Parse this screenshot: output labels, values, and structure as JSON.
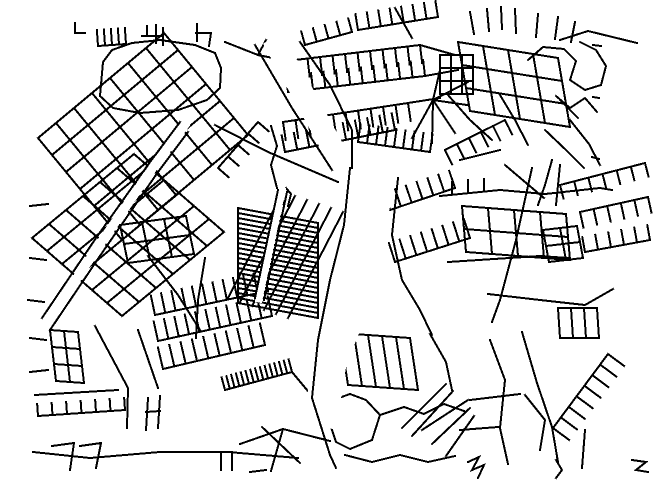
{
  "map": {
    "kind": "street-network-line-map",
    "canvas": {
      "width": 655,
      "height": 484
    },
    "colors": {
      "background": "#ffffff",
      "road": "#000000"
    },
    "stroke_width": 2,
    "grids": [
      {
        "o": [
          38,
          138
        ],
        "u": [
          14,
          17
        ],
        "nu": 6,
        "v": [
          18,
          -15
        ],
        "nv": 7
      },
      {
        "o": [
          32,
          238
        ],
        "u": [
          15,
          13
        ],
        "nu": 6,
        "v": [
          17,
          -14
        ],
        "nv": 6
      },
      {
        "o": [
          120,
          225
        ],
        "u": [
          22,
          -3
        ],
        "nu": 3,
        "v": [
          4,
          19
        ],
        "nv": 2
      },
      {
        "o": [
          238,
          208
        ],
        "u": [
          0,
          5
        ],
        "nu": 19,
        "v": [
          80,
          15
        ],
        "nv": 1
      },
      {
        "o": [
          458,
          42
        ],
        "u": [
          25,
          4
        ],
        "nu": 4,
        "v": [
          4,
          23
        ],
        "nv": 3
      },
      {
        "o": [
          462,
          206
        ],
        "u": [
          26,
          2
        ],
        "nu": 4,
        "v": [
          2,
          23
        ],
        "nv": 2
      },
      {
        "o": [
          543,
          230
        ],
        "u": [
          17,
          -2
        ],
        "nu": 2,
        "v": [
          3,
          16
        ],
        "nv": 2
      },
      {
        "o": [
          50,
          330
        ],
        "u": [
          14,
          1
        ],
        "nu": 2,
        "v": [
          2,
          17
        ],
        "nv": 3
      },
      {
        "o": [
          440,
          55
        ],
        "u": [
          11,
          0
        ],
        "nu": 3,
        "v": [
          0,
          13
        ],
        "nv": 3
      },
      {
        "o": [
          348,
          385
        ],
        "u": [
          14,
          1
        ],
        "nu": 5,
        "v": [
          -8,
          -52
        ],
        "nv": 1
      },
      {
        "o": [
          558,
          308
        ],
        "u": [
          13,
          0
        ],
        "nu": 3,
        "v": [
          2,
          30
        ],
        "nv": 1
      }
    ],
    "ladders": [
      {
        "a": [
          358,
          30
        ],
        "b": [
          438,
          17
        ],
        "n": 8,
        "len": 16,
        "ang": -90
      },
      {
        "a": [
          305,
          45
        ],
        "b": [
          352,
          32
        ],
        "n": 5,
        "len": 14,
        "ang": -90
      },
      {
        "a": [
          295,
          60
        ],
        "b": [
          420,
          45
        ],
        "n": 11,
        "len": 18,
        "ang": 90
      },
      {
        "a": [
          288,
          92
        ],
        "b": [
          425,
          76
        ],
        "n": 12,
        "len": 16,
        "ang": -90
      },
      {
        "a": [
          283,
          122
        ],
        "b": [
          408,
          103
        ],
        "n": 11,
        "len": 18,
        "ang": 90
      },
      {
        "a": [
          285,
          152
        ],
        "b": [
          395,
          130
        ],
        "n": 10,
        "len": 17,
        "ang": -90
      },
      {
        "a": [
          358,
          142
        ],
        "b": [
          430,
          152
        ],
        "n": 9,
        "len": 18,
        "ang": -90
      },
      {
        "a": [
          580,
          212
        ],
        "b": [
          648,
          197
        ],
        "n": 6,
        "len": 16,
        "ang": 90
      },
      {
        "a": [
          585,
          252
        ],
        "b": [
          650,
          240
        ],
        "n": 6,
        "len": 15,
        "ang": -90
      },
      {
        "a": [
          155,
          315
        ],
        "b": [
          268,
          291
        ],
        "n": 12,
        "len": 20,
        "ang": -90
      },
      {
        "a": [
          158,
          341
        ],
        "b": [
          272,
          316
        ],
        "n": 12,
        "len": 20,
        "ang": -90
      },
      {
        "a": [
          163,
          369
        ],
        "b": [
          265,
          345
        ],
        "n": 10,
        "len": 22,
        "ang": -90
      },
      {
        "a": [
          225,
          390
        ],
        "b": [
          292,
          372
        ],
        "n": 15,
        "len": 13,
        "ang": -90
      },
      {
        "a": [
          38,
          416
        ],
        "b": [
          125,
          410
        ],
        "n": 7,
        "len": 12,
        "ang": -90
      },
      {
        "a": [
          553,
          428
        ],
        "b": [
          608,
          354
        ],
        "n": 8,
        "len": 20,
        "ang": 90
      },
      {
        "a": [
          560,
          185
        ],
        "b": [
          645,
          163
        ],
        "n": 7,
        "len": 14,
        "ang": 90
      },
      {
        "a": [
          98,
          46
        ],
        "b": [
          126,
          44
        ],
        "n": 5,
        "len": 16,
        "ang": -90
      },
      {
        "a": [
          218,
          168
        ],
        "b": [
          258,
          122
        ],
        "n": 5,
        "len": 14,
        "ang": 90
      },
      {
        "a": [
          395,
          262
        ],
        "b": [
          470,
          238
        ],
        "n": 8,
        "len": 20,
        "ang": -90
      },
      {
        "a": [
          390,
          210
        ],
        "b": [
          455,
          188
        ],
        "n": 7,
        "len": 18,
        "ang": -90
      },
      {
        "a": [
          445,
          150
        ],
        "b": [
          505,
          120
        ],
        "n": 6,
        "len": 16,
        "ang": 90
      }
    ],
    "lines": [
      [
        75,
        23,
        75,
        33,
        85,
        33
      ],
      [
        142,
        36,
        163,
        36
      ],
      [
        147,
        26,
        147,
        36
      ],
      [
        156,
        25,
        156,
        43
      ],
      [
        163,
        28,
        163,
        45
      ],
      [
        197,
        24,
        197,
        41
      ],
      [
        196,
        33,
        211,
        33,
        209,
        46
      ],
      [
        100,
        96,
        103,
        62,
        112,
        50,
        132,
        43,
        160,
        40,
        195,
        45,
        215,
        53,
        221,
        68,
        220,
        88,
        207,
        100,
        178,
        110,
        140,
        113,
        113,
        108,
        100,
        96
      ],
      [
        215,
        125,
        268,
        152,
        310,
        170,
        338,
        182
      ],
      [
        225,
        42,
        258,
        55,
        283,
        60
      ],
      [
        258,
        55,
        266,
        40
      ],
      [
        277,
        188,
        271,
        165,
        277,
        146,
        271,
        126
      ],
      [
        284,
        206,
        281,
        193,
        286,
        188,
        291,
        194,
        288,
        206
      ],
      [
        240,
        302,
        295,
        196
      ],
      [
        252,
        306,
        307,
        200
      ],
      [
        264,
        310,
        319,
        204
      ],
      [
        276,
        314,
        331,
        208
      ],
      [
        288,
        318,
        343,
        212
      ],
      [
        228,
        298,
        283,
        192
      ],
      [
        433,
        100,
        468,
        82
      ],
      [
        433,
        100,
        467,
        105
      ],
      [
        433,
        100,
        455,
        133
      ],
      [
        433,
        100,
        432,
        143
      ],
      [
        433,
        100,
        412,
        138
      ],
      [
        433,
        100,
        440,
        70
      ],
      [
        560,
        40,
        588,
        31,
        637,
        43
      ],
      [
        470,
        12,
        474,
        34
      ],
      [
        487,
        9,
        489,
        31
      ],
      [
        501,
        7,
        502,
        29
      ],
      [
        515,
        9,
        516,
        33
      ],
      [
        538,
        14,
        536,
        37
      ],
      [
        558,
        17,
        555,
        39
      ],
      [
        575,
        22,
        571,
        42
      ],
      [
        395,
        8,
        412,
        38
      ],
      [
        528,
        60,
        543,
        47,
        564,
        49,
        576,
        61,
        570,
        80,
        585,
        90,
        601,
        85,
        606,
        66,
        596,
        50,
        580,
        42
      ],
      [
        593,
        45,
        601,
        46
      ],
      [
        593,
        97,
        599,
        98
      ],
      [
        592,
        157,
        599,
        159
      ],
      [
        570,
        120,
        589,
        144,
        600,
        165
      ],
      [
        560,
        100,
        578,
        118
      ],
      [
        545,
        130,
        566,
        150,
        584,
        168
      ],
      [
        556,
        96,
        570,
        108,
        585,
        98,
        597,
        112
      ],
      [
        440,
        196,
        500,
        190,
        545,
        194,
        600,
        188,
        612,
        190
      ],
      [
        452,
        182,
        452,
        194
      ],
      [
        468,
        180,
        468,
        192
      ],
      [
        484,
        179,
        484,
        191
      ],
      [
        448,
        262,
        540,
        256,
        568,
        258
      ],
      [
        532,
        168,
        516,
        240,
        500,
        300,
        492,
        322
      ],
      [
        488,
        294,
        540,
        300,
        585,
        305,
        613,
        289
      ],
      [
        505,
        165,
        525,
        182,
        544,
        198
      ],
      [
        552,
        160,
        545,
        185,
        538,
        205
      ],
      [
        560,
        165,
        556,
        205
      ],
      [
        448,
        95,
        470,
        120,
        492,
        140
      ],
      [
        500,
        95,
        515,
        120,
        528,
        145
      ],
      [
        460,
        160,
        500,
        150
      ],
      [
        420,
        45,
        455,
        55
      ],
      [
        425,
        76,
        458,
        70
      ],
      [
        408,
        103,
        440,
        98
      ],
      [
        35,
        395,
        118,
        390
      ],
      [
        33,
        452,
        90,
        458,
        160,
        452,
        228,
        452,
        298,
        458
      ],
      [
        52,
        446,
        74,
        443,
        70,
        470
      ],
      [
        80,
        446,
        101,
        443,
        96,
        468
      ],
      [
        148,
        398,
        146,
        430
      ],
      [
        160,
        396,
        158,
        428
      ],
      [
        146,
        412,
        160,
        411
      ],
      [
        95,
        326,
        128,
        388,
        127,
        428
      ],
      [
        138,
        330,
        158,
        388
      ],
      [
        30,
        372,
        48,
        370
      ],
      [
        30,
        338,
        46,
        340
      ],
      [
        221,
        470,
        221,
        452,
        232,
        452,
        232,
        470
      ],
      [
        250,
        472,
        266,
        470
      ],
      [
        240,
        444,
        283,
        429,
        330,
        441
      ],
      [
        262,
        427,
        300,
        463
      ],
      [
        283,
        429,
        271,
        471
      ],
      [
        333,
        400,
        350,
        394,
        366,
        400,
        380,
        415,
        372,
        440,
        350,
        449,
        336,
        442,
        330,
        424,
        333,
        400
      ],
      [
        380,
        415,
        404,
        407,
        424,
        414,
        444,
        404,
        464,
        411
      ],
      [
        345,
        455,
        372,
        462,
        400,
        455,
        428,
        462,
        455,
        456
      ],
      [
        468,
        400,
        422,
        430
      ],
      [
        470,
        408,
        432,
        444
      ],
      [
        474,
        416,
        446,
        456
      ],
      [
        446,
        384,
        402,
        428
      ],
      [
        453,
        391,
        412,
        436
      ],
      [
        468,
        462,
        479,
        457,
        472,
        470,
        484,
        465,
        478,
        478
      ],
      [
        632,
        460,
        646,
        462,
        636,
        470,
        648,
        472
      ],
      [
        556,
        460,
        562,
        470,
        556,
        478
      ],
      [
        522,
        332,
        537,
        383,
        552,
        427,
        558,
        462
      ],
      [
        490,
        340,
        505,
        380,
        500,
        428,
        508,
        464
      ],
      [
        470,
        400,
        520,
        394
      ],
      [
        460,
        430,
        498,
        427
      ],
      [
        525,
        395,
        545,
        420,
        540,
        450
      ],
      [
        585,
        430,
        582,
        468
      ],
      [
        30,
        206,
        48,
        204
      ],
      [
        30,
        258,
        46,
        260
      ],
      [
        28,
        300,
        44,
        302
      ],
      [
        205,
        258,
        198,
        300,
        196,
        338
      ],
      [
        148,
        256,
        178,
        295,
        200,
        330
      ],
      [
        292,
        372,
        312,
        396
      ],
      [
        430,
        334,
        446,
        362,
        452,
        390
      ]
    ],
    "white_roads": [
      {
        "pts": [
          374,
          200,
          362,
          260,
          350,
          310,
          330,
          360,
          322,
          410
        ],
        "w": 34
      },
      {
        "pts": [
          278,
          48,
          312,
          110,
          342,
          165
        ],
        "w": 22
      },
      {
        "pts": [
          259,
          299,
          282,
          191
        ],
        "w": 7
      },
      {
        "pts": [
          46,
          324,
          100,
          244,
          154,
          166,
          184,
          126
        ],
        "w": 9
      }
    ],
    "overlays": [
      [
        350,
        168,
        344,
        225,
        330,
        280,
        318,
        340,
        312,
        398,
        330,
        455,
        336,
        468
      ],
      [
        398,
        178,
        392,
        235,
        402,
        280,
        420,
        310,
        432,
        335
      ],
      [
        255,
        45,
        292,
        108,
        332,
        170
      ],
      [
        300,
        42,
        330,
        85,
        352,
        130,
        352,
        168
      ],
      [
        255,
        298,
        278,
        190
      ],
      [
        264,
        300,
        287,
        192
      ],
      [
        42,
        318,
        96,
        238,
        150,
        162,
        180,
        122
      ],
      [
        50,
        330,
        104,
        250,
        158,
        172,
        188,
        132
      ]
    ]
  }
}
